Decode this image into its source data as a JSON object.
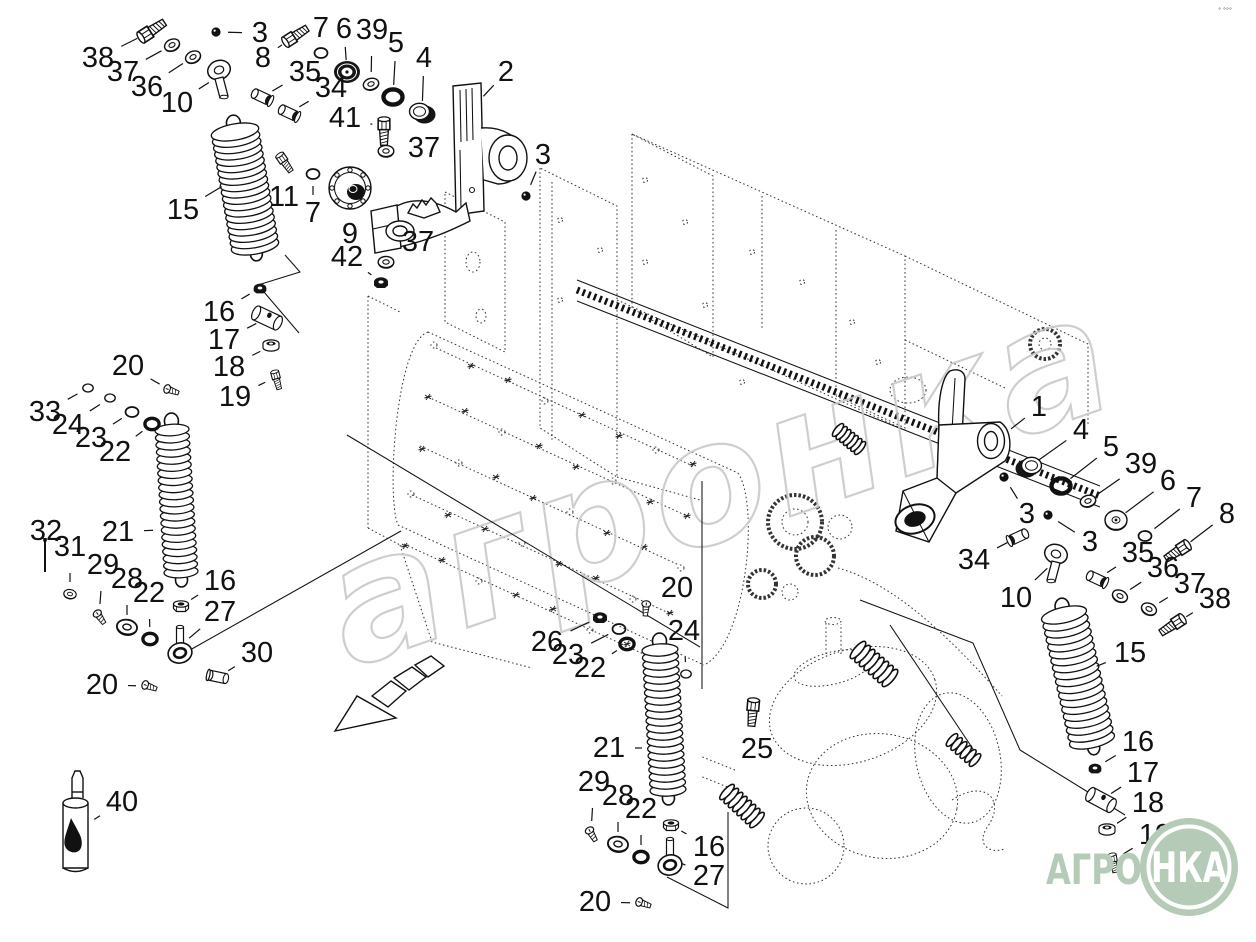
{
  "corner_marks": "° °°°",
  "watermark": {
    "text": "агронка",
    "color": "#c6c6c6"
  },
  "logo": {
    "prefix": "АГРО",
    "circle_text": "НКА",
    "color": "#b6cbb7",
    "ring_color": "#ffffff"
  },
  "callouts": [
    {
      "l": "38",
      "x": 98,
      "y": 58,
      "tx": 148,
      "ty": 33,
      "p": "bolt",
      "r": -33,
      "s": 1.4
    },
    {
      "l": "37",
      "x": 123,
      "y": 72,
      "tx": 172,
      "ty": 45,
      "p": "washer",
      "r": -25
    },
    {
      "l": "36",
      "x": 147,
      "y": 87,
      "tx": 193,
      "ty": 57,
      "p": "washer",
      "r": -25
    },
    {
      "l": "10",
      "x": 177,
      "y": 103,
      "tx": 219,
      "ty": 76,
      "p": "clevis"
    },
    {
      "l": "3",
      "x": 260,
      "y": 33,
      "tx": 216,
      "ty": 32,
      "p": "ball"
    },
    {
      "l": "8",
      "x": 263,
      "y": 58,
      "tx": 292,
      "ty": 38,
      "p": "bolt",
      "r": -33,
      "s": 1.3
    },
    {
      "l": "7",
      "x": 321,
      "y": 28,
      "tx": 321,
      "ty": 53,
      "p": "ring"
    },
    {
      "l": "6",
      "x": 344,
      "y": 29,
      "tx": 347,
      "ty": 72,
      "p": "grommet"
    },
    {
      "l": "39",
      "x": 372,
      "y": 30,
      "tx": 371,
      "ty": 84,
      "p": "washer",
      "r": -15
    },
    {
      "l": "5",
      "x": 396,
      "y": 43,
      "tx": 393,
      "ty": 97,
      "p": "oring"
    },
    {
      "l": "4",
      "x": 424,
      "y": 58,
      "tx": 422,
      "ty": 113,
      "p": "cup"
    },
    {
      "l": "35",
      "x": 305,
      "y": 72,
      "tx": 262,
      "ty": 97,
      "p": "sleeve",
      "r": 25
    },
    {
      "l": "34",
      "x": 331,
      "y": 88,
      "tx": 289,
      "ty": 113,
      "p": "sleeve",
      "r": 25
    },
    {
      "l": "41",
      "x": 345,
      "y": 118,
      "tx": 384,
      "ty": 127,
      "p": "bolt",
      "r": 90,
      "s": 1.3
    },
    {
      "l": "37",
      "x": 424,
      "y": 148,
      "tx": 386,
      "ty": 151,
      "p": "washer"
    },
    {
      "l": "2",
      "x": 506,
      "y": 72,
      "tx": 480,
      "ty": 100
    },
    {
      "l": "3",
      "x": 543,
      "y": 155,
      "tx": 526,
      "ty": 196,
      "p": "ball"
    },
    {
      "l": "11",
      "x": 284,
      "y": 197,
      "tx": 283,
      "ty": 160,
      "p": "bolt",
      "r": 55
    },
    {
      "l": "7",
      "x": 313,
      "y": 213,
      "tx": 313,
      "ty": 174,
      "p": "ring"
    },
    {
      "l": "9",
      "x": 350,
      "y": 234,
      "tx": 350,
      "ty": 212
    },
    {
      "l": "37",
      "x": 418,
      "y": 242,
      "tx": 386,
      "ty": 262,
      "p": "washer"
    },
    {
      "l": "42",
      "x": 347,
      "y": 257,
      "tx": 381,
      "ty": 282,
      "p": "darknut"
    },
    {
      "l": "15",
      "x": 183,
      "y": 210,
      "tx": 226,
      "ty": 184
    },
    {
      "l": "16",
      "x": 219,
      "y": 312,
      "tx": 260,
      "ty": 288,
      "p": "darknut",
      "s": 0.9
    },
    {
      "l": "17",
      "x": 224,
      "y": 340,
      "tx": 267,
      "ty": 318,
      "p": "barrel",
      "r": 25
    },
    {
      "l": "18",
      "x": 229,
      "y": 367,
      "tx": 271,
      "ty": 346,
      "p": "flwasher"
    },
    {
      "l": "19",
      "x": 235,
      "y": 397,
      "tx": 276,
      "ty": 377,
      "p": "bolt",
      "r": 75,
      "s": 0.9
    },
    {
      "l": "20",
      "x": 128,
      "y": 366,
      "tx": 170,
      "ty": 390,
      "p": "screw",
      "r": 20
    },
    {
      "l": "33",
      "x": 45,
      "y": 412,
      "tx": 88,
      "ty": 388,
      "p": "ring",
      "s": 0.8
    },
    {
      "l": "24",
      "x": 68,
      "y": 425,
      "tx": 110,
      "ty": 398,
      "p": "ring",
      "s": 0.8
    },
    {
      "l": "23",
      "x": 91,
      "y": 438,
      "tx": 132,
      "ty": 412,
      "p": "ring"
    },
    {
      "l": "22",
      "x": 115,
      "y": 452,
      "tx": 152,
      "ty": 424,
      "p": "oring",
      "s": 0.75
    },
    {
      "l": "21",
      "x": 118,
      "y": 532,
      "tx": 158,
      "ty": 530
    },
    {
      "l": "32",
      "x": 46,
      "y": 531,
      "tx": 45,
      "ty": 557,
      "p": "longpin"
    },
    {
      "l": "31",
      "x": 70,
      "y": 547,
      "tx": 70,
      "ty": 594,
      "p": "washer",
      "r": 10,
      "s": 0.8
    },
    {
      "l": "29",
      "x": 103,
      "y": 565,
      "tx": 99,
      "ty": 616,
      "p": "screw",
      "r": 55
    },
    {
      "l": "28",
      "x": 127,
      "y": 579,
      "tx": 127,
      "ty": 627,
      "p": "washer",
      "r": 10,
      "s": 1.3
    },
    {
      "l": "22",
      "x": 149,
      "y": 593,
      "tx": 150,
      "ty": 639,
      "p": "oring",
      "s": 0.75
    },
    {
      "l": "16",
      "x": 220,
      "y": 581,
      "tx": 181,
      "ty": 606,
      "p": "nut"
    },
    {
      "l": "27",
      "x": 220,
      "y": 612,
      "tx": 180,
      "ty": 646,
      "p": "eyebolt"
    },
    {
      "l": "30",
      "x": 257,
      "y": 653,
      "tx": 218,
      "ty": 677,
      "p": "pin",
      "r": 12
    },
    {
      "l": "20",
      "x": 102,
      "y": 685,
      "tx": 148,
      "ty": 686,
      "p": "screw",
      "r": 20
    },
    {
      "l": "40",
      "x": 122,
      "y": 802,
      "tx": 90,
      "ty": 822
    },
    {
      "l": "26",
      "x": 547,
      "y": 642,
      "tx": 600,
      "ty": 617,
      "p": "darknut"
    },
    {
      "l": "23",
      "x": 568,
      "y": 655,
      "tx": 619,
      "ty": 629,
      "p": "ring"
    },
    {
      "l": "22",
      "x": 590,
      "y": 668,
      "tx": 627,
      "ty": 644,
      "p": "oring",
      "s": 0.75
    },
    {
      "l": "20",
      "x": 677,
      "y": 588,
      "tx": 646,
      "ty": 607,
      "p": "screw",
      "r": 95
    },
    {
      "l": "24",
      "x": 684,
      "y": 631,
      "tx": 686,
      "ty": 674,
      "p": "ring",
      "s": 0.8
    },
    {
      "l": "25",
      "x": 757,
      "y": 749,
      "tx": 753,
      "ty": 708,
      "p": "bolt",
      "r": 95,
      "s": 1.3
    },
    {
      "l": "21",
      "x": 609,
      "y": 748,
      "tx": 647,
      "ty": 748
    },
    {
      "l": "29",
      "x": 594,
      "y": 782,
      "tx": 591,
      "ty": 833,
      "p": "screw",
      "r": 60
    },
    {
      "l": "28",
      "x": 618,
      "y": 796,
      "tx": 618,
      "ty": 844,
      "p": "washer",
      "r": 10,
      "s": 1.3
    },
    {
      "l": "22",
      "x": 641,
      "y": 809,
      "tx": 641,
      "ty": 857,
      "p": "oring",
      "s": 0.75
    },
    {
      "l": "16",
      "x": 709,
      "y": 847,
      "tx": 671,
      "ty": 825,
      "p": "nut"
    },
    {
      "l": "27",
      "x": 709,
      "y": 876,
      "tx": 670,
      "ty": 858,
      "p": "eyebolt"
    },
    {
      "l": "20",
      "x": 595,
      "y": 902,
      "tx": 642,
      "ty": 903,
      "p": "screw",
      "r": 20
    },
    {
      "l": "1",
      "x": 1039,
      "y": 407,
      "tx": 1007,
      "ty": 432
    },
    {
      "l": "4",
      "x": 1081,
      "y": 430,
      "tx": 1029,
      "ty": 467,
      "p": "cup",
      "f": true
    },
    {
      "l": "5",
      "x": 1111,
      "y": 447,
      "tx": 1061,
      "ty": 486,
      "p": "oring"
    },
    {
      "l": "39",
      "x": 1141,
      "y": 464,
      "tx": 1088,
      "ty": 501,
      "p": "washer",
      "r": -15
    },
    {
      "l": "6",
      "x": 1168,
      "y": 481,
      "tx": 1116,
      "ty": 520,
      "p": "disc"
    },
    {
      "l": "7",
      "x": 1194,
      "y": 498,
      "tx": 1145,
      "ty": 536,
      "p": "ring"
    },
    {
      "l": "8",
      "x": 1227,
      "y": 514,
      "tx": 1181,
      "ty": 549,
      "p": "bolt",
      "r": 147,
      "s": 1.3
    },
    {
      "l": "3",
      "x": 1027,
      "y": 514,
      "tx": 1004,
      "ty": 477,
      "p": "ball"
    },
    {
      "l": "3",
      "x": 1090,
      "y": 542,
      "tx": 1048,
      "ty": 515,
      "p": "ball"
    },
    {
      "l": "34",
      "x": 974,
      "y": 560,
      "tx": 1018,
      "ty": 537,
      "p": "sleeve",
      "r": 25,
      "f": true
    },
    {
      "l": "10",
      "x": 1016,
      "y": 598,
      "tx": 1056,
      "ty": 560,
      "p": "clevis",
      "f": true
    },
    {
      "l": "35",
      "x": 1138,
      "y": 553,
      "tx": 1097,
      "ty": 579,
      "p": "sleeve",
      "r": 25
    },
    {
      "l": "36",
      "x": 1163,
      "y": 568,
      "tx": 1120,
      "ty": 596,
      "p": "washer",
      "r": 25
    },
    {
      "l": "37",
      "x": 1190,
      "y": 584,
      "tx": 1149,
      "ty": 609,
      "p": "washer",
      "r": 25
    },
    {
      "l": "38",
      "x": 1215,
      "y": 599,
      "tx": 1176,
      "ty": 623,
      "p": "bolt",
      "r": 147,
      "s": 1.3
    },
    {
      "l": "15",
      "x": 1130,
      "y": 653,
      "tx": 1092,
      "ty": 668
    },
    {
      "l": "16",
      "x": 1138,
      "y": 742,
      "tx": 1095,
      "ty": 768,
      "p": "darknut",
      "s": 0.9
    },
    {
      "l": "17",
      "x": 1143,
      "y": 773,
      "tx": 1101,
      "ty": 800,
      "p": "barrel",
      "r": 28
    },
    {
      "l": "18",
      "x": 1148,
      "y": 803,
      "tx": 1107,
      "ty": 830,
      "p": "flwasher"
    },
    {
      "l": "19",
      "x": 1155,
      "y": 835,
      "tx": 1113,
      "ty": 860,
      "p": "bolt",
      "r": 80,
      "s": 0.9
    }
  ]
}
